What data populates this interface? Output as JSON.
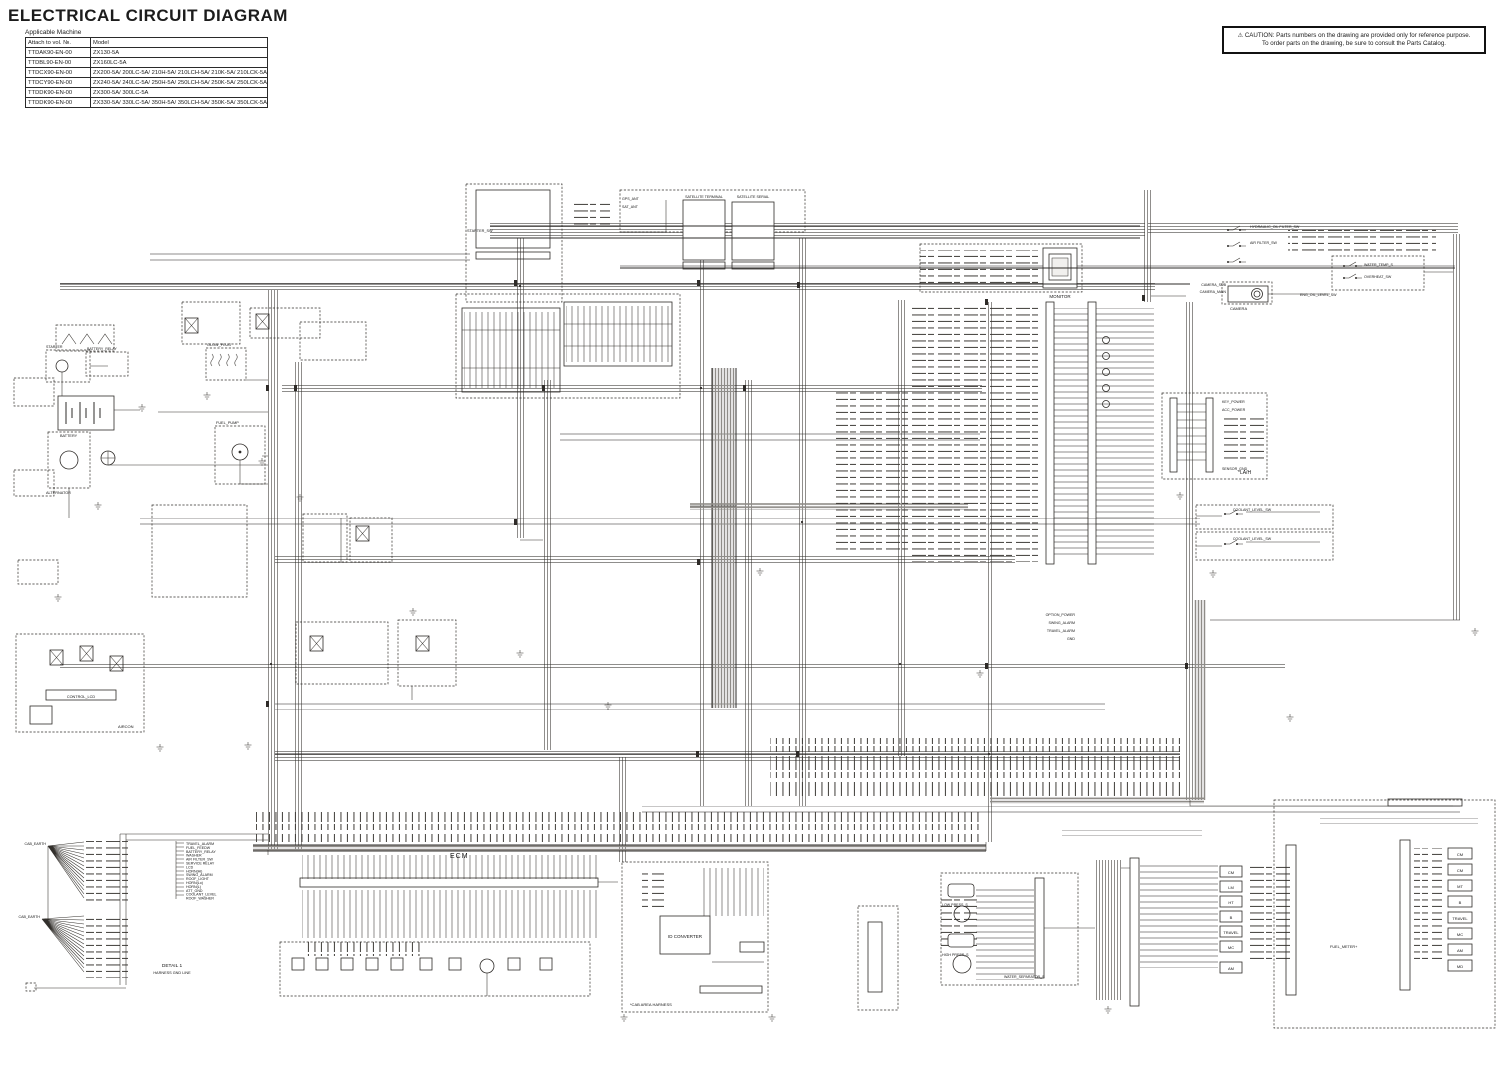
{
  "header": {
    "title": "ELECTRICAL CIRCUIT DIAGRAM",
    "applicable_machine": "Applicable Machine"
  },
  "caution": {
    "line1": "⚠ CAUTION: Parts numbers on the drawing are provided only for reference purpose.",
    "line2": "To order parts on the drawing, be sure to consult the Parts Catalog."
  },
  "machine_table": {
    "headers": [
      "Attach to vol. №.",
      "Model"
    ],
    "rows": [
      [
        "TTDAK90-EN-00",
        "ZX130-5A"
      ],
      [
        "TTDBL90-EN-00",
        "ZX160LC-5A"
      ],
      [
        "TTDCX90-EN-00",
        "ZX200-5A/ 200LC-5A/ 210H-5A/ 210LCH-5A/ 210K-5A/ 210LCK-5A"
      ],
      [
        "TTDCY90-EN-00",
        "ZX240-5A/ 240LC-5A/ 250H-5A/ 250LCH-5A/ 250K-5A/ 250LCK-5A"
      ],
      [
        "TTDDK90-EN-00",
        "ZX300-5A/ 300LC-5A"
      ],
      [
        "TTDDK90-EN-00",
        "ZX330-5A/ 330LC-5A/ 350H-5A/ 350LCH-5A/ 350K-5A/ 350LCK-5A"
      ]
    ]
  },
  "diagram": {
    "labels": {
      "ecm": "ECM",
      "starter_sw": "STARTER_SW",
      "satellite_terminal": "SATELLITE TERMINAL",
      "satellite_serial": "SATELLITE SERIAL",
      "gps_ant": "GPS_ANT",
      "sat_ant": "SAT_ANT",
      "monitor": "MONITOR",
      "camera": "CAMERA",
      "camera_main": "CAMERA_MAIN",
      "camera_sub": "CAMERA_SUB",
      "hyd_filter_sw": "HYDRAULIC_OIL FILTER_SW",
      "air_filter_sw": "AIR FILTER_SW",
      "water_temp_s": "WATER_TEMP_S",
      "overheat_sw": "OVERHEAT_SW",
      "eng_oil_level_sw": "ENG_OIL_LEVEL_SW",
      "glow_plug": "GLOW_PLUG",
      "battery_relay": "BATTERY_RELAY",
      "starter": "STARTER",
      "battery": "BATTERY",
      "alternator": "ALTERNATOR",
      "fuel_pump": "FUEL_PUMP",
      "control_lcd": "CONTROL_LCD",
      "aircon": "AIRCON",
      "la_h": "*LA/H",
      "coolant_level_sw": "COOLANT_LEVEL_SW",
      "key_power": "KEY_POWER",
      "acc_power": "ACC_POWER",
      "sensor_gnd": "SENSOR_GND",
      "option_power": "OPTION_POWER",
      "swing_alarm": "SWING_ALARM",
      "travel_alarm": "TRAVEL_ALARM",
      "gnd": "GND",
      "id_converter": "ID CONVERTER",
      "cab_area": "*CAB AREA HARNESS",
      "detail1": "DETAIL 1",
      "harness_gnd_line": "HARNESS GND LINE",
      "cab_earth": "CAB_EARTH",
      "water_separator_s": "WATER_SEPARATOR_S",
      "low_press_s": "LOW PRESS_S",
      "high_press_s": "HIGH PRESS_S",
      "fuel_meter": "FUEL_METER+"
    },
    "relays_left": [
      "CM",
      "LM",
      "HT",
      "B",
      "TRAVEL",
      "MC",
      "AM"
    ],
    "relays_right": [
      "CM",
      "CM",
      "MT",
      "B",
      "TRAVEL",
      "MC",
      "AM",
      "MD"
    ],
    "gnd_list": [
      "TRAVEL_ALARM",
      "FUEL_FEEDW",
      "BATTERY_RELAY",
      "WASHER",
      "AIR FILTER_SW",
      "SERVICE RELAY",
      "LCD",
      "HORN(Hi)",
      "SWING_ALARM",
      "ROOF_LIGHT",
      "HORN(Lo)",
      "HORN(L)",
      "ATT_GND",
      "COOLANT_LEVEL",
      "ROOF_WASHER"
    ]
  },
  "colors": {
    "wire": "#33302c",
    "bus_gray": "#8f8c88",
    "paper": "#ffffff"
  }
}
